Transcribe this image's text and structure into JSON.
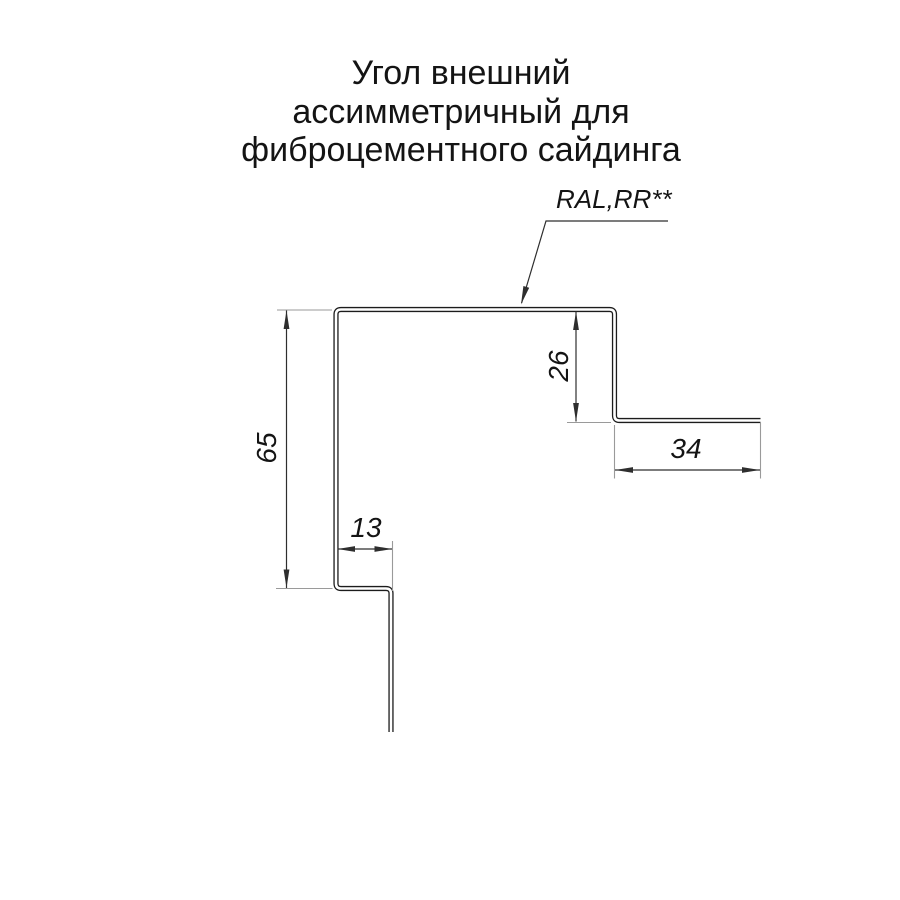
{
  "title": {
    "lines": [
      "Угол внешний",
      "ассимметричный для",
      "фиброцементного сайдинга"
    ]
  },
  "callout": {
    "label": "RAL,RR**"
  },
  "dimensions": {
    "left_height_mm": "65",
    "right_return_mm": "26",
    "right_flange_mm": "34",
    "bottom_step_mm": "13"
  },
  "colors": {
    "line": "#1c1c1c",
    "dim_line": "#2e2e2e",
    "ext_line": "#9a9a9a",
    "text": "#141414",
    "background": "#ffffff"
  }
}
